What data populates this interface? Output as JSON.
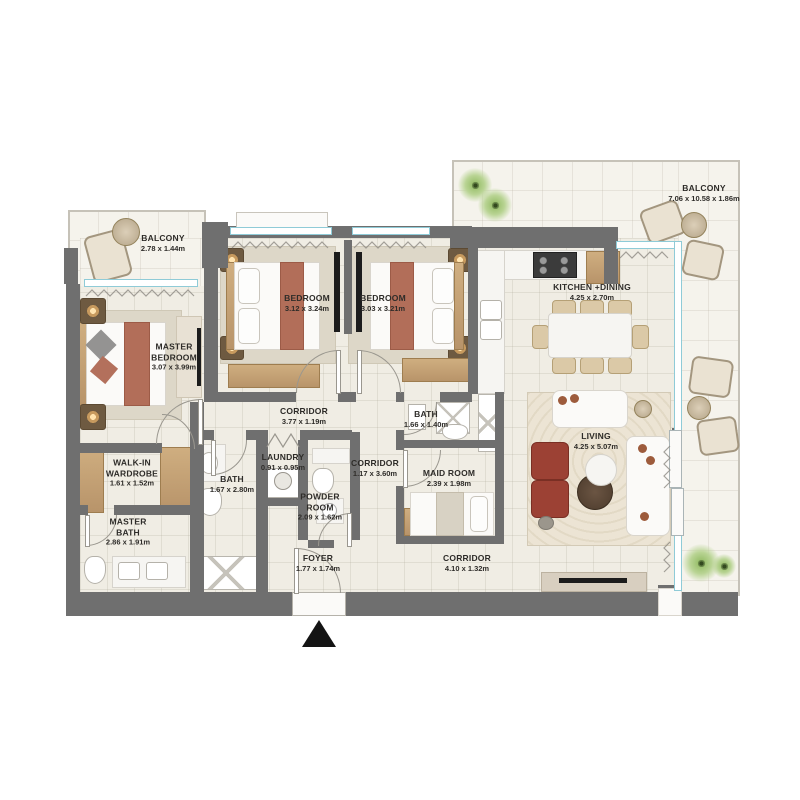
{
  "plan_type": "apartment-floor-plan",
  "palette": {
    "wall": "#6f6f6f",
    "floor": "#f0ede4",
    "balcony_floor": "#f5f3ec",
    "window_glass": "#8fcbd7",
    "wood": "#c2a176",
    "bed_runner_terracotta": "#b26e59",
    "armchair_red": "#9c4134",
    "label_text": "#2e2c29",
    "plant_green": "#7da84f",
    "black_accent": "#1c1c1c"
  },
  "rooms": [
    {
      "id": "balcony-top-left",
      "name": "BALCONY",
      "dims": "2.78 x 1.44m"
    },
    {
      "id": "master-bedroom",
      "name": "MASTER\nBEDROOM",
      "dims": "3.07 x 3.99m"
    },
    {
      "id": "bedroom-2",
      "name": "BEDROOM",
      "dims": "3.12 x 3.24m"
    },
    {
      "id": "bedroom-3",
      "name": "BEDROOM",
      "dims": "3.03 x 3.21m"
    },
    {
      "id": "kitchen-dining",
      "name": "KITCHEN +DINING",
      "dims": "4.25 x 2.70m"
    },
    {
      "id": "balcony-right",
      "name": "BALCONY",
      "dims": "7.06 x 10.58 x 1.86m"
    },
    {
      "id": "corridor-bedrooms",
      "name": "CORRIDOR",
      "dims": "3.77 x 1.19m"
    },
    {
      "id": "bath-2",
      "name": "BATH",
      "dims": "1.66 x 1.40m"
    },
    {
      "id": "living",
      "name": "LIVING",
      "dims": "4.25 x 5.07m"
    },
    {
      "id": "walk-in-wardrobe",
      "name": "WALK-IN\nWARDROBE",
      "dims": "1.61 x 1.52m"
    },
    {
      "id": "bath-1",
      "name": "BATH",
      "dims": "1.67 x 2.80m"
    },
    {
      "id": "laundry",
      "name": "LAUNDRY",
      "dims": "0.91 x 0.95m"
    },
    {
      "id": "corridor-middle",
      "name": "CORRIDOR",
      "dims": "1.17 x 3.60m"
    },
    {
      "id": "maid-room",
      "name": "MAID ROOM",
      "dims": "2.39 x 1.98m"
    },
    {
      "id": "powder-room",
      "name": "POWDER\nROOM",
      "dims": "2.09 x 1.62m"
    },
    {
      "id": "master-bath",
      "name": "MASTER\nBATH",
      "dims": "2.86 x 1.91m"
    },
    {
      "id": "foyer",
      "name": "FOYER",
      "dims": "1.77 x 1.74m"
    },
    {
      "id": "corridor-entry",
      "name": "CORRIDOR",
      "dims": "4.10 x 1.32m"
    }
  ]
}
